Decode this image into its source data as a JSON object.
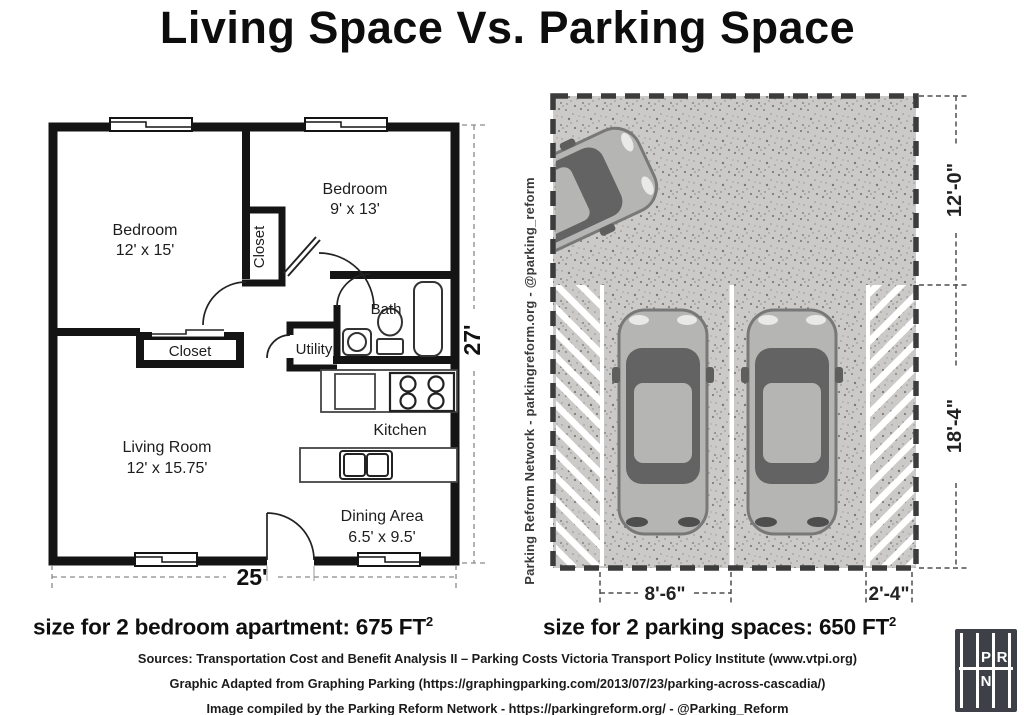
{
  "title": "Living Space Vs. Parking Space",
  "floor_plan": {
    "rooms": {
      "bedroom_left": {
        "name": "Bedroom",
        "dims": "12' x 15'"
      },
      "bedroom_right": {
        "name": "Bedroom",
        "dims": "9' x 13'"
      },
      "hall_closet": {
        "name": "Closet"
      },
      "bath": {
        "name": "Bath"
      },
      "utility": {
        "name": "Utility"
      },
      "lower_closet": {
        "name": "Closet"
      },
      "kitchen": {
        "name": "Kitchen"
      },
      "living_room": {
        "name": "Living Room",
        "dims": "12' x 15.75'"
      },
      "dining_area": {
        "name": "Dining Area",
        "dims": "6.5' x 9.5'"
      }
    },
    "width_label": "25'",
    "height_label": "27'"
  },
  "parking": {
    "watermark": "Parking Reform Network - parkingreform.org - @parking_reform",
    "dim_aisle_depth": "12'-0\"",
    "dim_stall_depth": "18'-4\"",
    "dim_stall_width": "8'-6\"",
    "dim_buffer_width": "2'-4\""
  },
  "captions": {
    "apartment": {
      "text": "size for 2 bedroom apartment: 675 FT",
      "sup": "2"
    },
    "parking": {
      "text": "size for 2 parking spaces: 650 FT",
      "sup": "2"
    }
  },
  "footer": {
    "lines": [
      "Sources: Transportation Cost and Benefit Analysis II – Parking Costs Victoria Transport Policy Institute (www.vtpi.org)",
      "Graphic Adapted from Graphing Parking (https://graphingparking.com/2013/07/23/parking-across-cascadia/)",
      "Image compiled by the Parking Reform Network - https://parkingreform.org/ - @Parking_Reform"
    ]
  },
  "logo": {
    "p": "P",
    "r": "R",
    "n": "N"
  },
  "colors": {
    "pavement": "#cbcac8",
    "car_body": "#b5b5b3",
    "car_glass": "#636363",
    "ink": "#111111"
  }
}
